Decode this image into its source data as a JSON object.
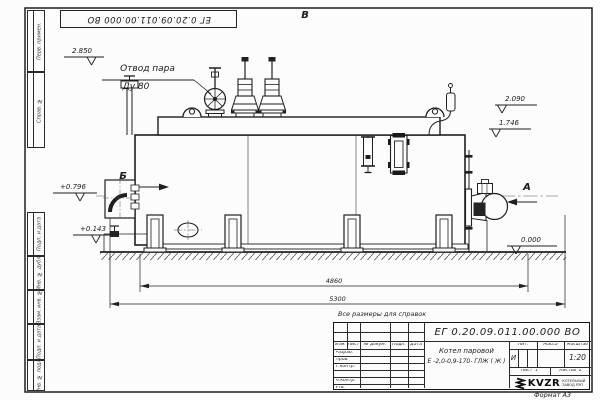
{
  "sheet": {
    "stamp": "ЕГ 0.20.09.011.00.000  ВО",
    "format_note": "Формат А3",
    "reference_note": "Все размеры для справок"
  },
  "margin": {
    "col_perv": "Перв. примен.",
    "col_sprav": "Справ. №",
    "col_podp1": "Подп. и дата",
    "col_inv_dubl": "Инв. № дубл.",
    "col_vzam": "Взам. инв. №",
    "col_podp2": "Подп. и дата",
    "col_inv_podl": "Инв. № подл."
  },
  "views": {
    "a": "А",
    "b": "Б",
    "v": "В"
  },
  "labels": {
    "steam_outlet_1": "Отвод пара",
    "steam_outlet_2": "Ду 80"
  },
  "levels": {
    "v2850": "2.850",
    "v2090": "2.090",
    "v1746": "1.746",
    "p0796": "+0.796",
    "p0143": "+0.143",
    "zero": "0.000"
  },
  "dims": {
    "inner": "4860",
    "outer": "5300"
  },
  "title_block": {
    "doc_number": "ЕГ 0.20.09.011.00.000  ВО",
    "product_1": "Котел паровой",
    "product_2": "Е -2,0-0,9-170- ГЛЖ ( Ж )",
    "h_izm": "Изм.",
    "h_list": "Лист",
    "h_doc": "№ докум.",
    "h_podp": "Подп.",
    "h_data": "Дата",
    "r_razrab": "Разраб.",
    "r_prov": "Пров.",
    "r_tkontr": "Т.контр.",
    "r_nkontr": "Н.контр.",
    "r_utv": "Утв.",
    "h_lit": "Лит.",
    "h_mass": "Масса",
    "h_scale": "Масштаб",
    "lit_value": "И",
    "scale_value": "1:20",
    "sheet_label": "Лист",
    "sheet_value": "1",
    "sheets_label": "Листов",
    "sheets_value": "2",
    "logo": "KVZR",
    "logo_sub1": "КОТЕЛЬНЫЙ",
    "logo_sub2": "ЗАВОД РЭП"
  }
}
